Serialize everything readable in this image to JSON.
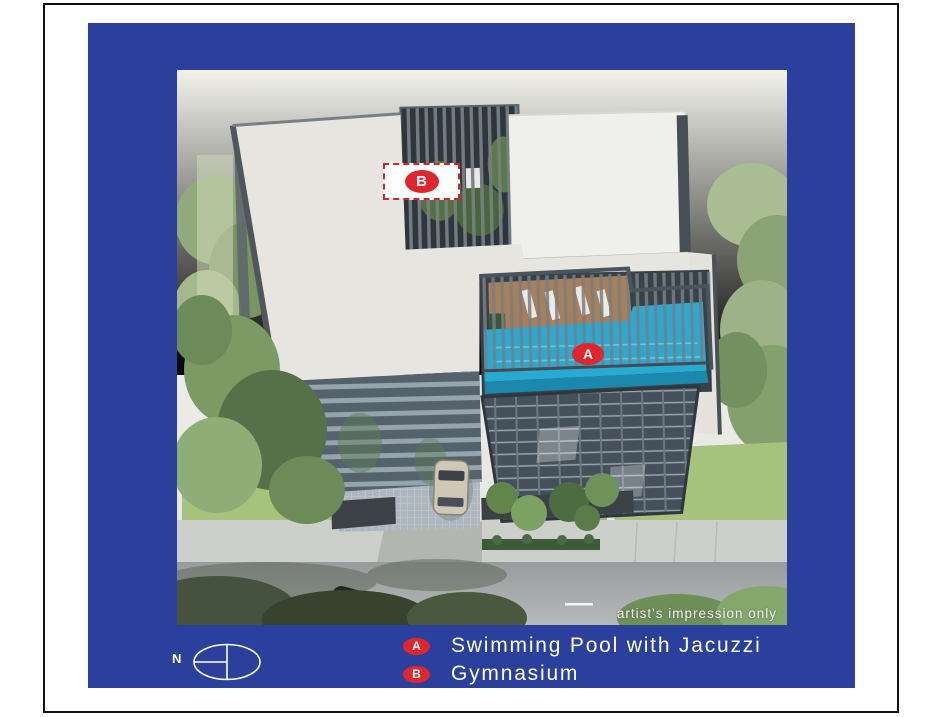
{
  "compass": {
    "north_label": "N"
  },
  "scene": {
    "marker_a": "A",
    "marker_b": "B",
    "watermark": "artist's impression only"
  },
  "legend": {
    "items": [
      {
        "key": "A",
        "label": "Swimming Pool with Jacuzzi"
      },
      {
        "key": "B",
        "label": "Gymnasium"
      }
    ]
  },
  "colors": {
    "frame_blue": "#2b3f9c",
    "marker_red": "#e0262d",
    "pool_cyan": "#29aad3",
    "legend_text": "#ffffff"
  }
}
